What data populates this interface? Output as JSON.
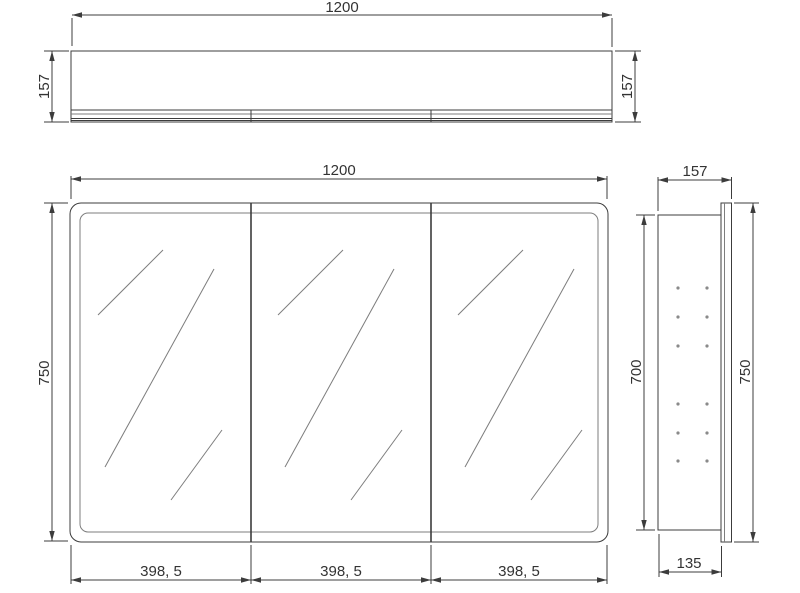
{
  "drawing": {
    "background": "#ffffff",
    "line_color": "#3c3c3c",
    "accent_line_color": "#7d7d7d",
    "text_color": "#333333",
    "views": {
      "top": {
        "width": "1200",
        "depth_left": "157",
        "depth_right": "157"
      },
      "front": {
        "width": "1200",
        "height": "750",
        "door_widths": [
          "398, 5",
          "398, 5",
          "398, 5"
        ]
      },
      "side": {
        "depth": "157",
        "carcass_height": "700",
        "door_height": "750",
        "carcass_depth": "135"
      }
    }
  }
}
